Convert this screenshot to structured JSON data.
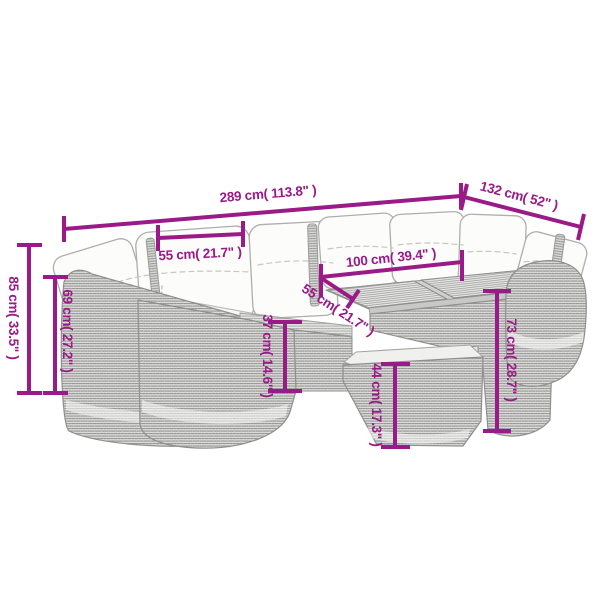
{
  "diagram": {
    "accent_color": "#9a1a87",
    "sketch_color": "#9a9a9a",
    "dimensions": {
      "total_width": {
        "label": "289 cm( 113.8\" )"
      },
      "right_depth": {
        "label": "132 cm( 52\" )"
      },
      "seat_width": {
        "label": "55 cm( 21.7\" )"
      },
      "table_width": {
        "label": "100 cm( 39.4\" )"
      },
      "seat_depth": {
        "label": "55 cm( 21.7\" )"
      },
      "back_height": {
        "label": "85 cm( 33.5\" )"
      },
      "arm_height": {
        "label": "69 cm( 27.2\" )"
      },
      "seat_height": {
        "label": "37 cm( 14.6\" )"
      },
      "ottoman_height": {
        "label": "44 cm( 17.3\" )"
      },
      "table_height": {
        "label": "73 cm( 28.7\" )"
      }
    }
  }
}
